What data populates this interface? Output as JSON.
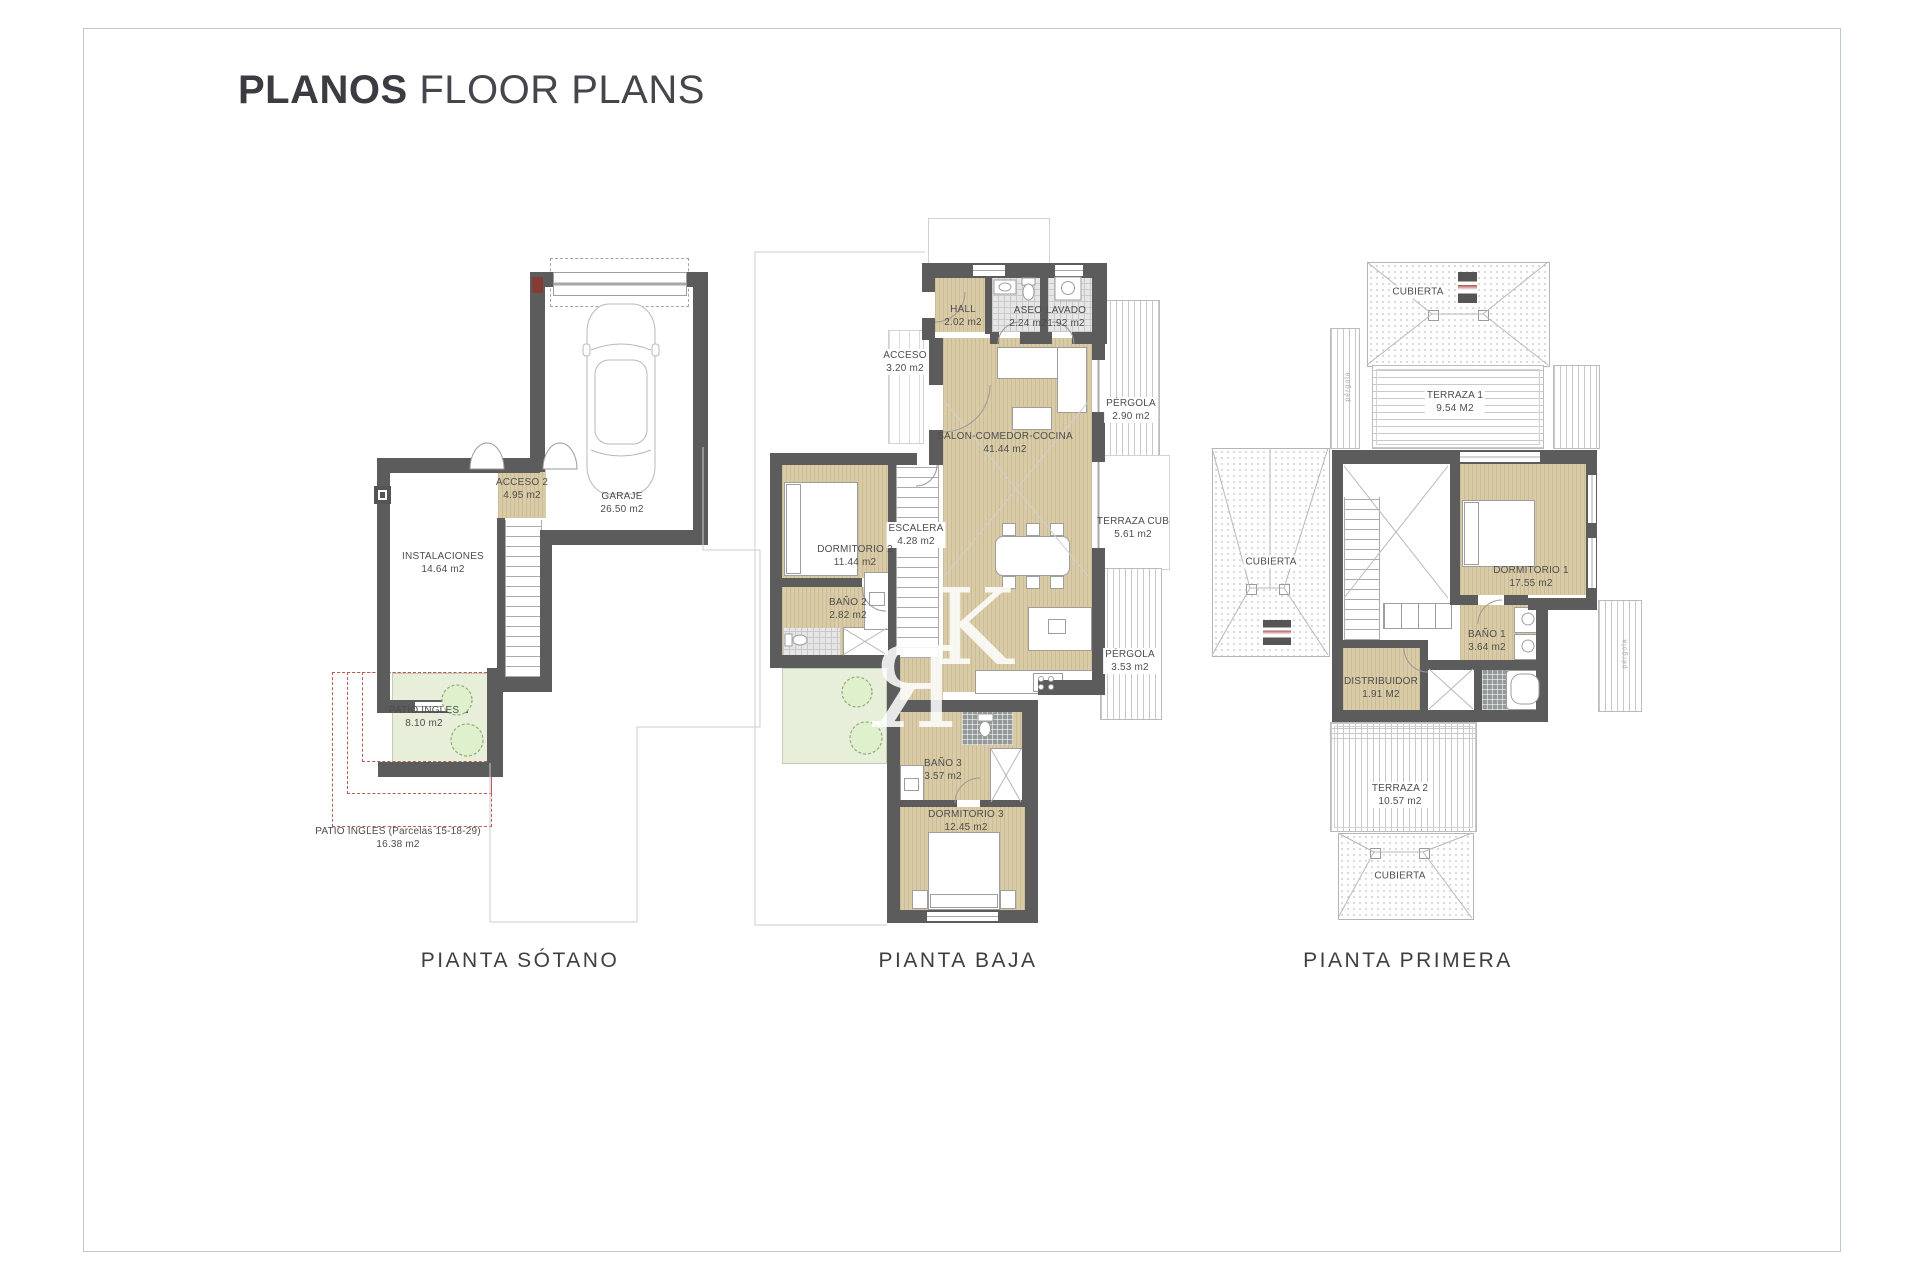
{
  "title": {
    "bold": "PLANOS",
    "rest": "FLOOR PLANS"
  },
  "watermark": {
    "ya": "Я",
    "k": "K"
  },
  "side_labels": {
    "pergola": "pérgola"
  },
  "colors": {
    "wall": "#5c5c5c",
    "floor_beige": "#d8cba6",
    "patio_green": "#e7efda",
    "dashed_red": "#b85c50",
    "frame_border": "#b9c9cf"
  },
  "plans": {
    "sotano": {
      "label": "PIANTA SÓTANO",
      "rooms": {
        "acceso2": {
          "name": "ACCESO 2",
          "area": "4.95 m2"
        },
        "garaje": {
          "name": "GARAJE",
          "area": "26.50 m2"
        },
        "instalaciones": {
          "name": "INSTALACIONES",
          "area": "14.64 m2"
        },
        "patio": {
          "name": "PATIO INGLES",
          "area": "8.10 m2"
        },
        "patio_parcelas": {
          "name": "PATIO INGLES (Parcelas 15-18-29)",
          "area": "16.38 m2"
        }
      }
    },
    "baja": {
      "label": "PIANTA BAJA",
      "rooms": {
        "hall": {
          "name": "HALL",
          "area": "2.02 m2"
        },
        "aseo": {
          "name": "ASEO",
          "area": "2.24 m2"
        },
        "lavado": {
          "name": "LAVADO",
          "area": "1.92 m2"
        },
        "acceso": {
          "name": "ACCESO",
          "area": "3.20 m2"
        },
        "salon": {
          "name": "SALON-COMEDOR-COCINA",
          "area": "41.44 m2"
        },
        "escalera": {
          "name": "ESCALERA",
          "area": "4.28 m2"
        },
        "dormitorio2": {
          "name": "DORMITORIO 2",
          "area": "11.44 m2"
        },
        "bano2": {
          "name": "BAÑO 2",
          "area": "2.82 m2"
        },
        "pergola1": {
          "name": "PÉRGOLA",
          "area": "2.90 m2"
        },
        "terraza_cub": {
          "name": "TERRAZA CUB",
          "area": "5.61 m2"
        },
        "pergola2": {
          "name": "PÉRGOLA",
          "area": "3.53 m2"
        },
        "bano3": {
          "name": "BAÑO 3",
          "area": "3.57 m2"
        },
        "dormitorio3": {
          "name": "DORMITORIO 3",
          "area": "12.45 m2"
        }
      }
    },
    "primera": {
      "label": "PIANTA PRIMERA",
      "rooms": {
        "cubierta_top": {
          "name": "CUBIERTA"
        },
        "terraza1": {
          "name": "TERRAZA 1",
          "area": "9.54 M2"
        },
        "cubierta_left": {
          "name": "CUBIERTA"
        },
        "dormitorio1": {
          "name": "DORMITORIO 1",
          "area": "17.55 m2"
        },
        "bano1": {
          "name": "BAÑO 1",
          "area": "3.64 m2"
        },
        "distribuidor": {
          "name": "DISTRIBUIDOR",
          "area": "1.91 M2"
        },
        "terraza2": {
          "name": "TERRAZA 2",
          "area": "10.57 m2"
        },
        "cubierta_bottom": {
          "name": "CUBIERTA"
        }
      }
    }
  }
}
